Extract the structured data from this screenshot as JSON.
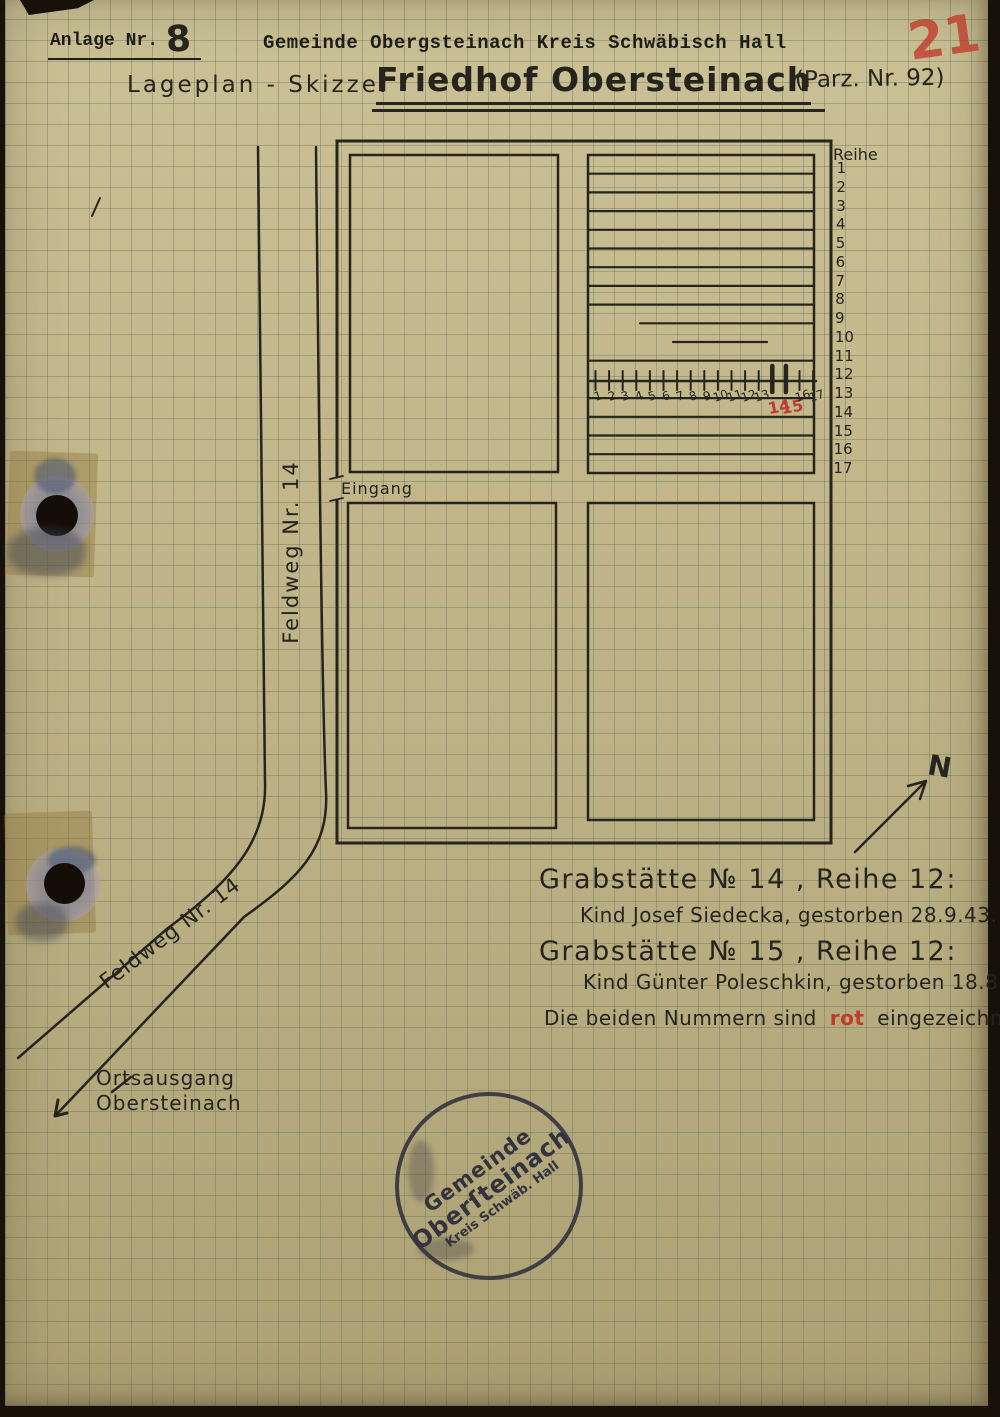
{
  "document": {
    "anlage_label": "Anlage Nr.",
    "anlage_number": "8",
    "gemeinde_line": "Gemeinde Obergsteinach Kreis Schwäbisch Hall",
    "title_prefix": "Lageplan - Skizze:",
    "title": "Friedhof Obersteinach",
    "parcel": "(Parz. Nr. 92)",
    "page_number": "21"
  },
  "map": {
    "reihe_label": "Reihe",
    "row_labels": [
      "1",
      "2",
      "3",
      "4",
      "5",
      "6",
      "7",
      "8",
      "9",
      "10",
      "11",
      "12",
      "13",
      "14",
      "15",
      "16",
      "17"
    ],
    "grave_numbers": [
      {
        "label": "1"
      },
      {
        "label": "2"
      },
      {
        "label": "3"
      },
      {
        "label": "4"
      },
      {
        "label": "5"
      },
      {
        "label": "6"
      },
      {
        "label": "7"
      },
      {
        "label": "8"
      },
      {
        "label": "9"
      },
      {
        "label": "10"
      },
      {
        "label": "11"
      },
      {
        "label": "12"
      },
      {
        "label": "13"
      },
      {
        "label": "14",
        "red": true
      },
      {
        "label": "15",
        "red": true
      },
      {
        "label": "16"
      },
      {
        "label": "17"
      }
    ],
    "eingang_label": "Eingang",
    "feldweg_vertical_label": "Feldweg Nr. 14",
    "feldweg_diagonal_label": "Feldweg Nr. 14",
    "north_label": "N",
    "exit_line1": "Ortsausgang",
    "exit_line2": "Obersteinach"
  },
  "notes": {
    "grave14_title": "Grabstätte № 14 , Reihe 12:",
    "grave14_detail": "Kind Josef Siedecka, gestorben 28.9.43.",
    "grave15_title": "Grabstätte № 15 , Reihe 12:",
    "grave15_detail": "Kind Günter Poleschkin, gestorben 18.8.44.",
    "note_prefix": "Die beiden Nummern sind",
    "note_red_word": "rot",
    "note_suffix": "eingezeichnet"
  },
  "stamp": {
    "line1": "Gemeinde",
    "line2": "Oberſteinach",
    "line3": "Kreis Schwäb. Hall"
  },
  "colors": {
    "red_ink": "#bf3b2c",
    "black_ink": "#26241d",
    "paper": "#bdb287",
    "stamp_ink": "#34333d"
  }
}
